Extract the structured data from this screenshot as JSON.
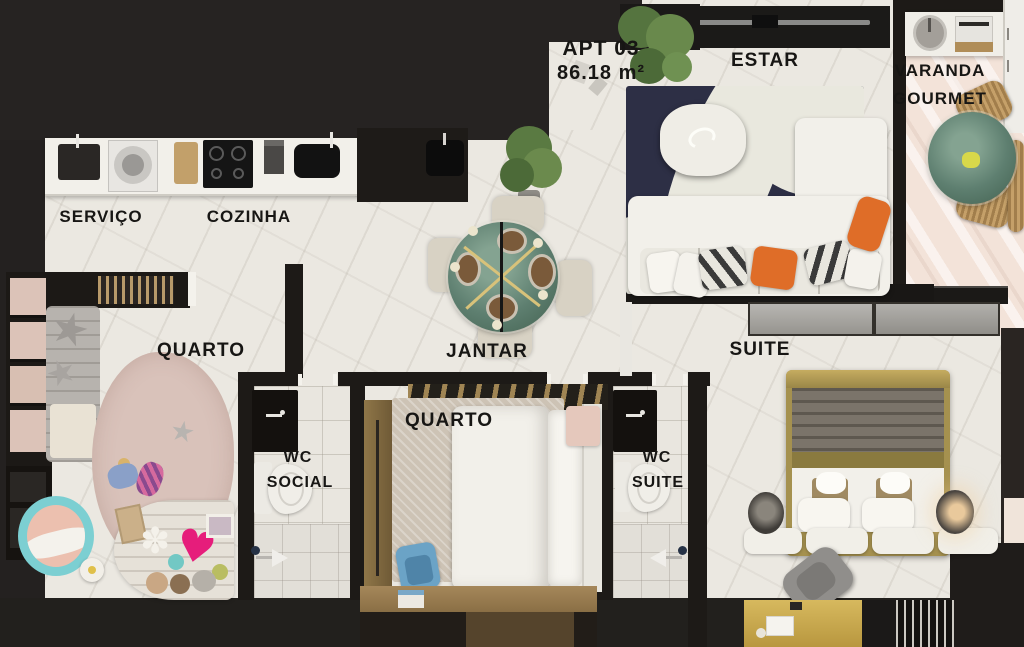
{
  "unit": {
    "label": "APT 03",
    "area": "86.18 m²"
  },
  "rooms": {
    "servico": {
      "label": "SERVIÇO"
    },
    "cozinha": {
      "label": "COZINHA"
    },
    "quarto_esquerda": {
      "label": "QUARTO"
    },
    "jantar": {
      "label": "JANTAR"
    },
    "estar": {
      "label": "ESTAR"
    },
    "varanda_gourmet": {
      "line1": "VARANDA",
      "line2": "GOURMET"
    },
    "suite": {
      "label": "SUITE"
    },
    "wc_social": {
      "line1": "WC",
      "line2": "SOCIAL"
    },
    "quarto_centro": {
      "label": "QUARTO"
    },
    "wc_suite": {
      "line1": "WC",
      "line2": "SUITE"
    }
  },
  "icons": {
    "star_pillow": "★",
    "heart_toy": "♥",
    "flower_toy": "✽"
  },
  "colors": {
    "outside_dark": "#242120",
    "wall": "#1d1a17",
    "floor_marble": "#ebe8e1",
    "floor_varanda": "#f3e3d9",
    "rug_estar_navy": "#2d2f45",
    "rug_kids_pink": "#d9c2ba",
    "rug_quarto_beige": "#cdc3b5",
    "sofa_white": "#f2f0ea",
    "pillow_orange": "#df6d28",
    "table_green_marble": "#5e7f70",
    "dining_chair_cream": "#d8d2c4",
    "wicker_tan": "#c5a069",
    "crib_teal": "#7ccfd2",
    "crib_pink": "#ecc0af",
    "toy_heart_pink": "#e61d7b",
    "desk_chair_blue": "#6ba3c6",
    "suite_bed_gold": "#a5914f",
    "suite_desk_gold": "#c5a54a",
    "wood": "#8a744c"
  }
}
